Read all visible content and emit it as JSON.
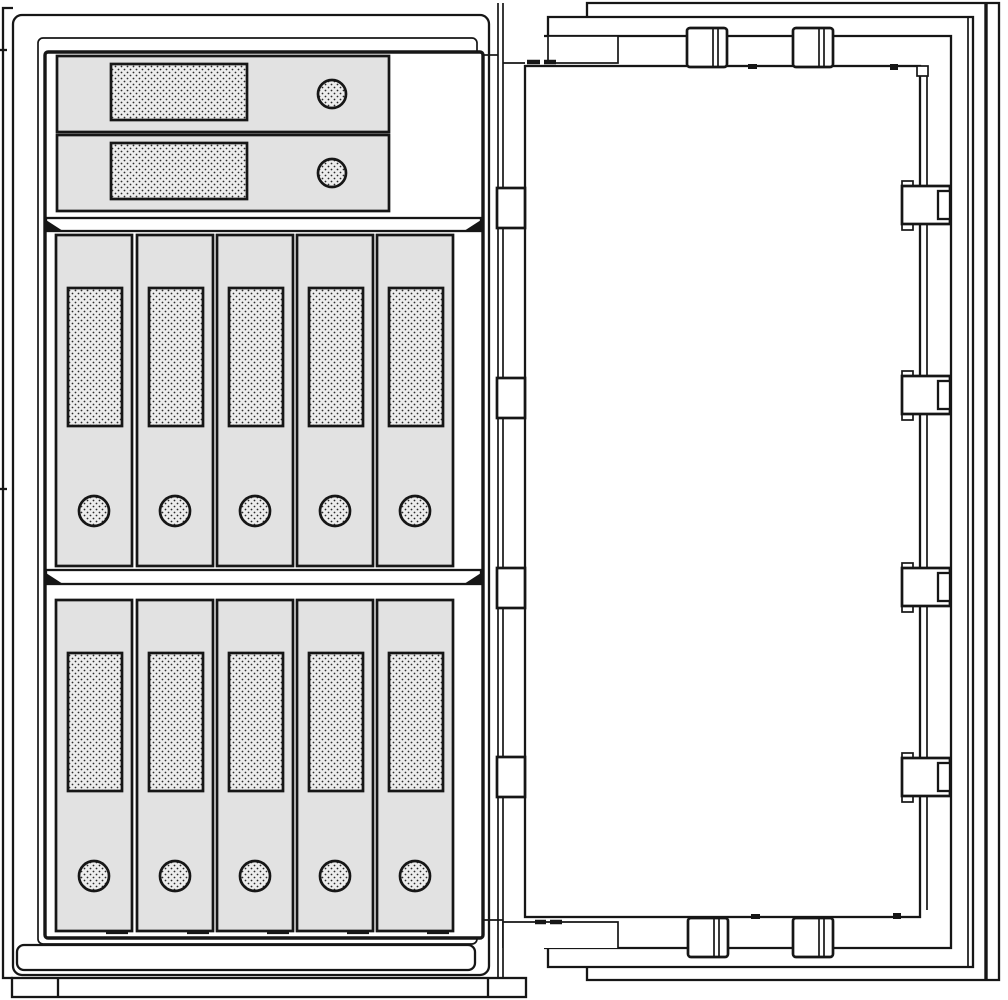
{
  "title": "Technical line drawing of a document safe: two drawers and ten binders on two shelves inside, open door with locking bolts and hinges",
  "colors": {
    "bg": "#ffffff",
    "line": "#161616",
    "panel": "#e2e2e2",
    "label": "#ededed",
    "dot": "#2b2b2b"
  },
  "inventory": {
    "drawers": 2,
    "shelves": 2,
    "binders_per_shelf": 5,
    "binders_total": 10,
    "door_hinges": 4,
    "lock_bolts_right_edge": 4,
    "lock_bolts_top_edge": 2,
    "lock_bolts_bottom_edge": 2
  },
  "instances": [
    {
      "tpl": "tpl-drawer",
      "name": "drawer-1",
      "x": 57,
      "y": 56
    },
    {
      "tpl": "tpl-drawer",
      "name": "drawer-2",
      "x": 57,
      "y": 135
    },
    {
      "tpl": "tpl-binder",
      "name": "binder-upper-1",
      "x": 56,
      "y": 235
    },
    {
      "tpl": "tpl-binder",
      "name": "binder-upper-2",
      "x": 137,
      "y": 235
    },
    {
      "tpl": "tpl-binder",
      "name": "binder-upper-3",
      "x": 217,
      "y": 235
    },
    {
      "tpl": "tpl-binder",
      "name": "binder-upper-4",
      "x": 297,
      "y": 235
    },
    {
      "tpl": "tpl-binder",
      "name": "binder-upper-5",
      "x": 377,
      "y": 235
    },
    {
      "tpl": "tpl-binder",
      "name": "binder-lower-1",
      "x": 56,
      "y": 600
    },
    {
      "tpl": "tpl-binder",
      "name": "binder-lower-2",
      "x": 137,
      "y": 600
    },
    {
      "tpl": "tpl-binder",
      "name": "binder-lower-3",
      "x": 217,
      "y": 600
    },
    {
      "tpl": "tpl-binder",
      "name": "binder-lower-4",
      "x": 297,
      "y": 600
    },
    {
      "tpl": "tpl-binder",
      "name": "binder-lower-5",
      "x": 377,
      "y": 600
    },
    {
      "tpl": "tpl-hinge",
      "name": "door-hinge-1",
      "x": 497,
      "y": 188
    },
    {
      "tpl": "tpl-hinge",
      "name": "door-hinge-2",
      "x": 497,
      "y": 378
    },
    {
      "tpl": "tpl-hinge",
      "name": "door-hinge-3",
      "x": 497,
      "y": 568
    },
    {
      "tpl": "tpl-hinge",
      "name": "door-hinge-4",
      "x": 497,
      "y": 757
    },
    {
      "tpl": "tpl-bolt-right",
      "name": "lock-bolt-right-1",
      "x": 901,
      "y": 181
    },
    {
      "tpl": "tpl-bolt-right",
      "name": "lock-bolt-right-2",
      "x": 901,
      "y": 371
    },
    {
      "tpl": "tpl-bolt-right",
      "name": "lock-bolt-right-3",
      "x": 901,
      "y": 563
    },
    {
      "tpl": "tpl-bolt-right",
      "name": "lock-bolt-right-4",
      "x": 901,
      "y": 753
    },
    {
      "tpl": "tpl-bolt-vert",
      "name": "lock-bolt-top-1",
      "x": 687,
      "y": 28
    },
    {
      "tpl": "tpl-bolt-vert",
      "name": "lock-bolt-top-2",
      "x": 793,
      "y": 28
    },
    {
      "tpl": "tpl-bolt-vert",
      "name": "lock-bolt-bottom-1",
      "x": 688,
      "y": 918
    },
    {
      "tpl": "tpl-bolt-vert",
      "name": "lock-bolt-bottom-2",
      "x": 793,
      "y": 918
    }
  ]
}
